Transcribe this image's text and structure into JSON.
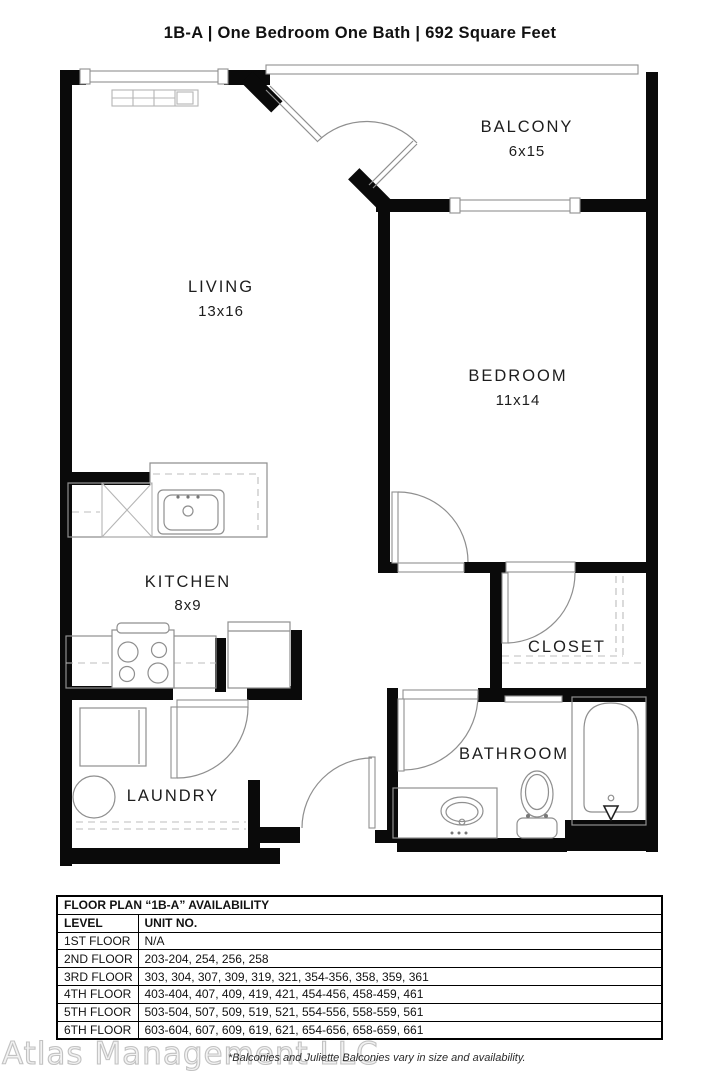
{
  "title": "1B-A | One Bedroom One Bath | 692 Square Feet",
  "floor_plan": {
    "rooms": [
      {
        "name": "LIVING",
        "dims": "13x16"
      },
      {
        "name": "BALCONY",
        "dims": "6x15"
      },
      {
        "name": "BEDROOM",
        "dims": "11x14"
      },
      {
        "name": "KITCHEN",
        "dims": "8x9"
      },
      {
        "name": "CLOSET",
        "dims": ""
      },
      {
        "name": "BATHROOM",
        "dims": ""
      },
      {
        "name": "LAUNDRY",
        "dims": ""
      }
    ],
    "fixtures": [
      "dishwasher",
      "kitchen-sink",
      "stove",
      "refrigerator",
      "washer",
      "water-heater",
      "vanity-sink",
      "toilet",
      "bathtub",
      "baseboard-heater"
    ]
  },
  "availability_table": {
    "title": "FLOOR PLAN “1B-A” AVAILABILITY",
    "columns": [
      "LEVEL",
      "UNIT NO."
    ],
    "rows": [
      [
        "1ST FLOOR",
        "N/A"
      ],
      [
        "2ND FLOOR",
        "203-204, 254, 256, 258"
      ],
      [
        "3RD FLOOR",
        "303, 304, 307, 309, 319, 321, 354-356, 358, 359, 361"
      ],
      [
        "4TH FLOOR",
        "403-404, 407, 409, 419, 421, 454-456, 458-459, 461"
      ],
      [
        "5TH FLOOR",
        "503-504, 507, 509, 519, 521, 554-556, 558-559, 561"
      ],
      [
        "6TH FLOOR",
        "603-604, 607, 609, 619, 621, 654-656, 658-659, 661"
      ]
    ]
  },
  "footer": {
    "watermark": "Atlas Management LLC",
    "note": "*Balconies and Juliette Balconies vary in size and availability."
  },
  "colors": {
    "wall": "#0a0a0a",
    "line": "#8f8f8f",
    "text": "#111111"
  }
}
